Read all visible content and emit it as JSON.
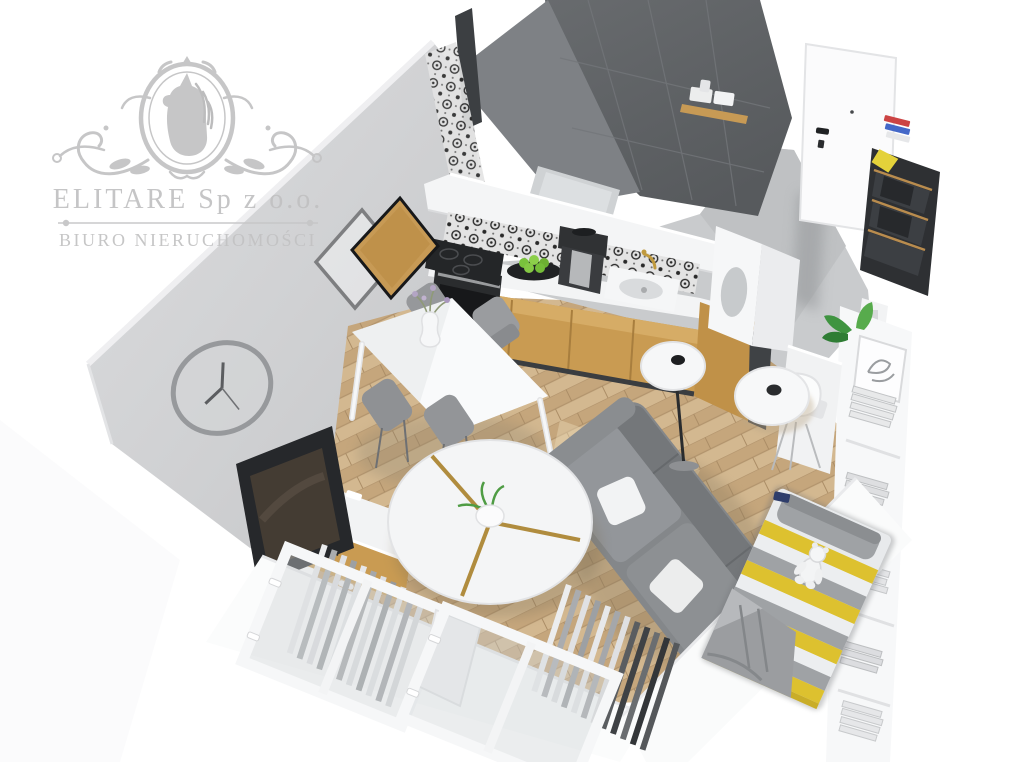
{
  "watermark": {
    "company": "ELITARE Sp z o.o.",
    "subtitle": "BIURO NIERUCHOMOŚCI",
    "color": "#c2c2c3",
    "emblem": "horse-head-in-laurel-oval-crest"
  },
  "scene": {
    "type": "3d-apartment-cutaway-render",
    "view": "top-down isometric from above-left",
    "rooms": [
      "living-room",
      "kitchen",
      "bathroom",
      "entry-hall",
      "sleeping-nook",
      "balcony-windows"
    ],
    "objects": [
      "wall-clock",
      "two-diamond-picture-frames",
      "flat-tv",
      "tv-stand",
      "white-dining-table",
      "four-gray-chairs",
      "flower-vase",
      "oven",
      "cooktop",
      "oak-kitchen-cabinets",
      "patterned-backsplash",
      "kitchen-sink",
      "gold-faucet",
      "coffee-machine",
      "plate-of-green-apples",
      "bathtub",
      "towel-shelf",
      "dark-tiled-bathroom-wall",
      "white-entry-door",
      "wardrobe-with-hangers",
      "colorful-books",
      "white-desk",
      "white-shell-chair",
      "bookshelf-with-books",
      "potted-plant",
      "framed-sketch",
      "gray-sofa",
      "white-pillows",
      "round-split-coffee-table",
      "floor-lamp",
      "white-stool",
      "bed-with-yellow-gray-striped-bedding",
      "teddy-bear",
      "gray-blanket",
      "two-windows",
      "slatted-radiators",
      "wood-plank-floor",
      "gray-kitchen-floor"
    ]
  },
  "palette": {
    "background": "#ffffff",
    "wall_gray": "#d2d3d5",
    "bathroom_tile_dark": "#5f6265",
    "kitchen_floor_gray": "#c9cbcd",
    "wood_floor": "#ccae86",
    "oak_cabinet": "#c99b52",
    "sofa_gray": "#8a8d90",
    "bed_yellow": "#ddc12f",
    "bed_gray": "#9fa2a5",
    "door_white": "#fbfbfc",
    "greenery": "#4f9c44",
    "watermark_gray": "#c2c2c3"
  }
}
